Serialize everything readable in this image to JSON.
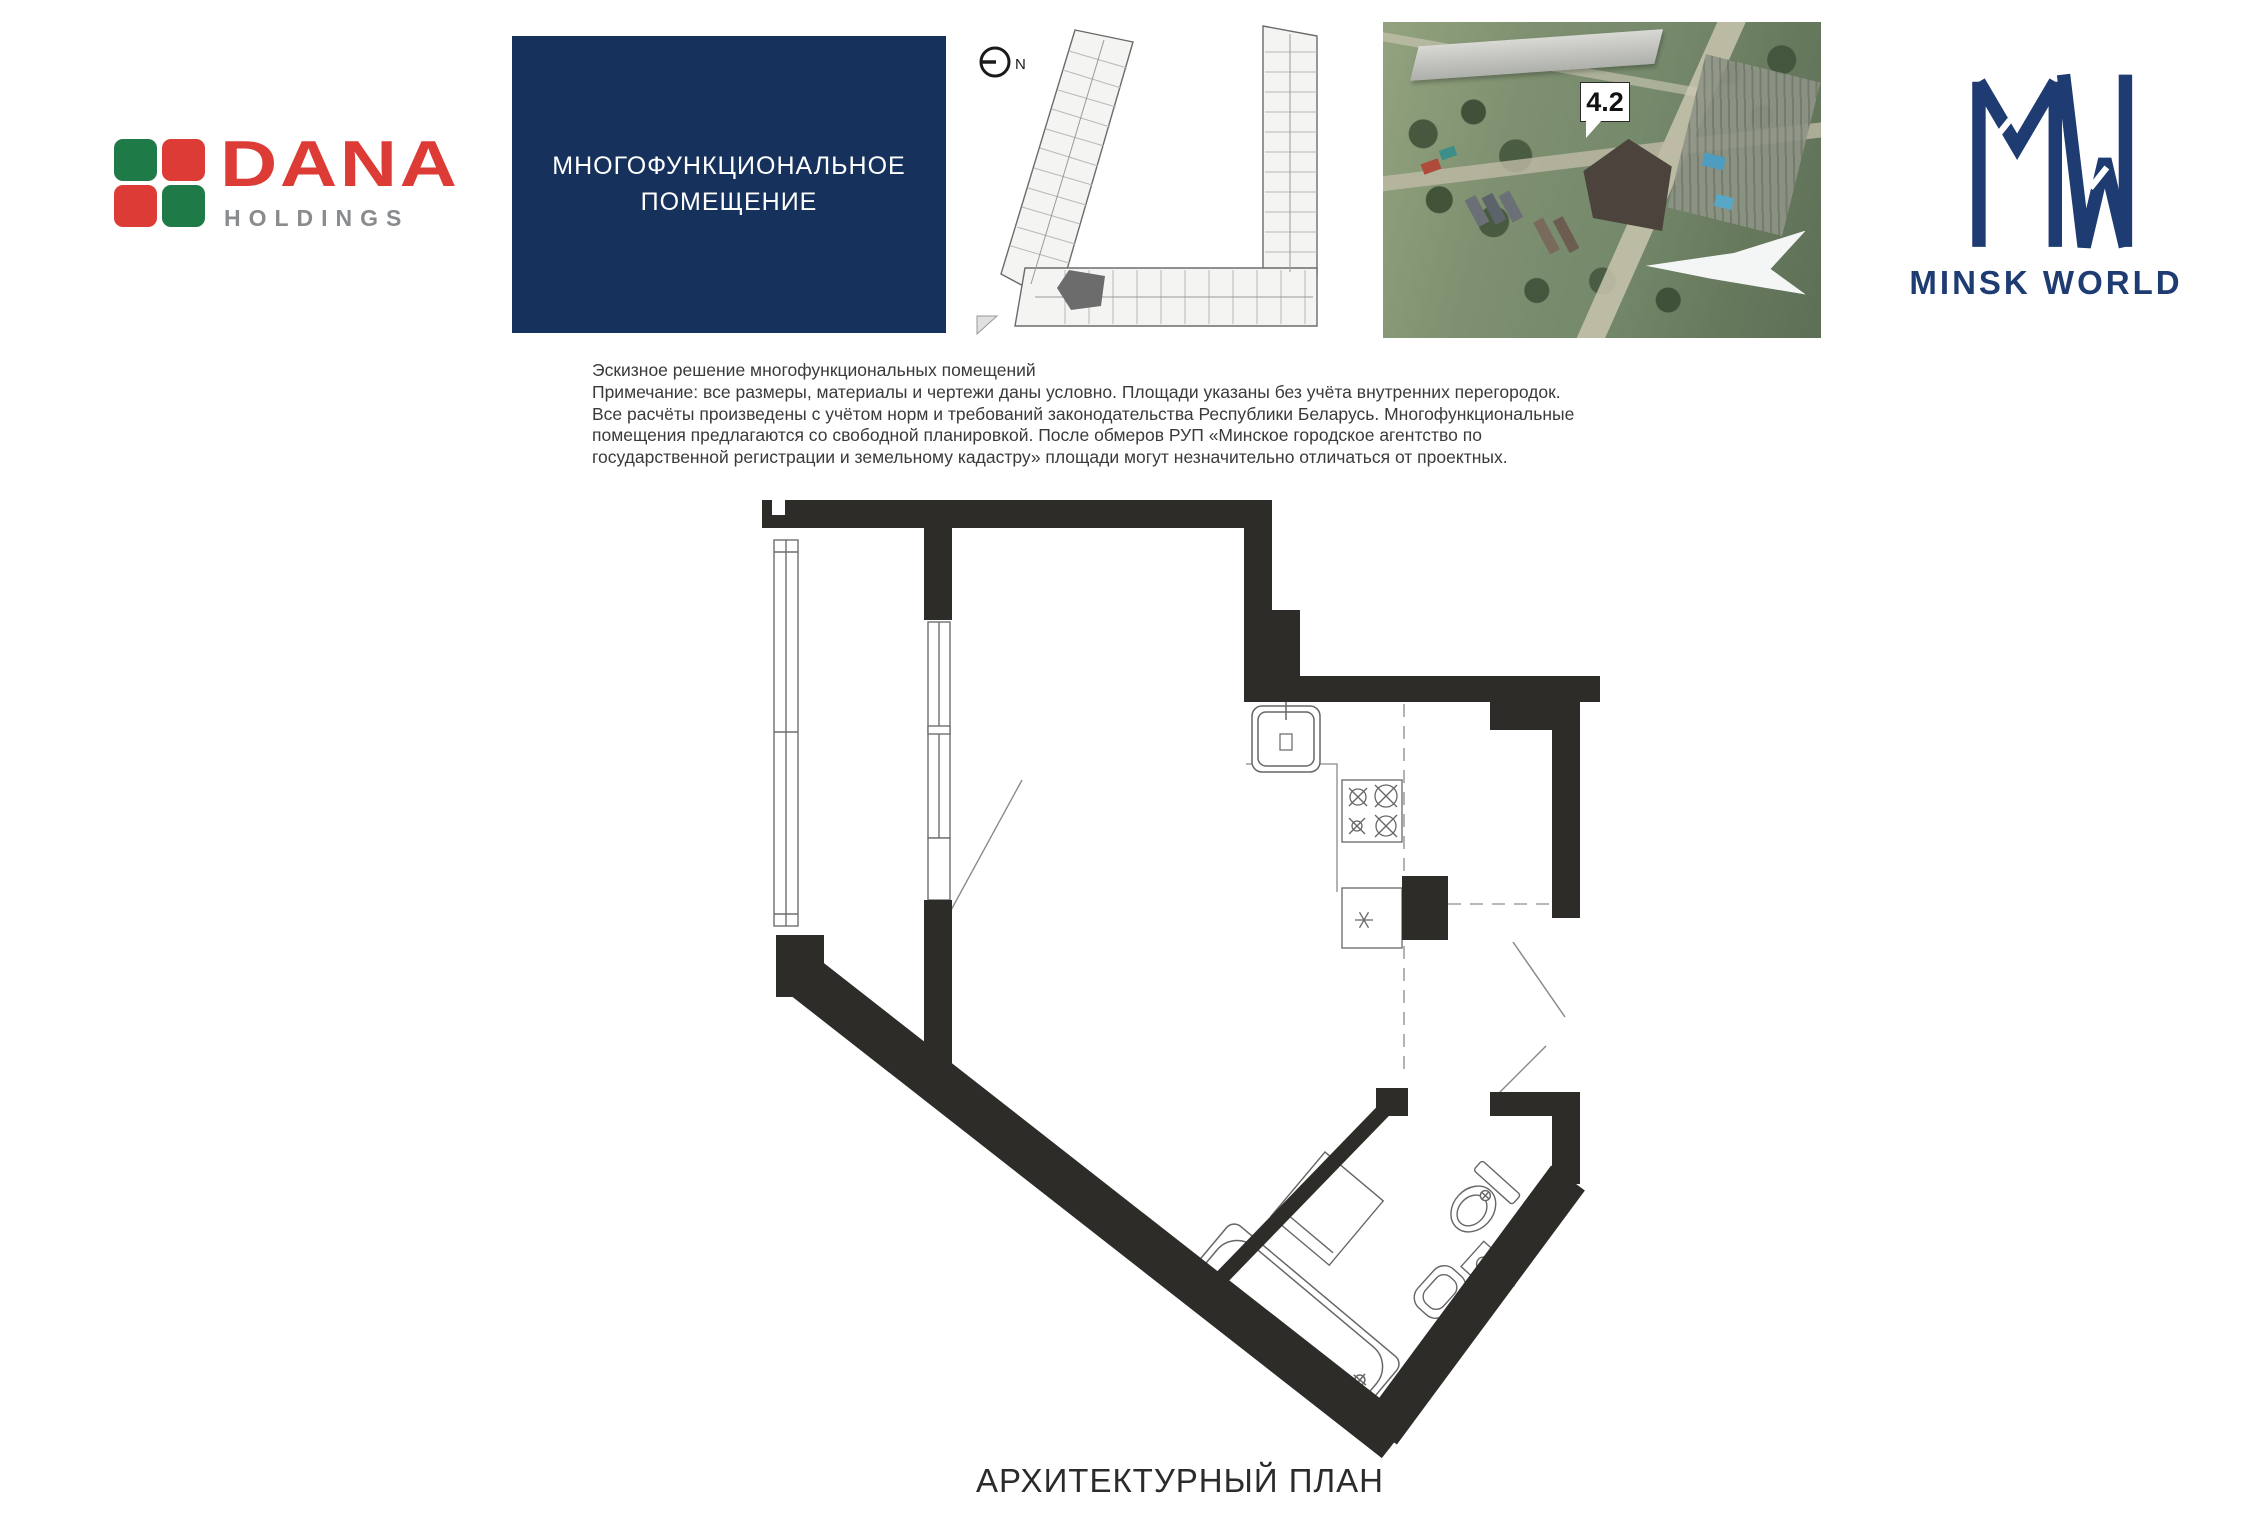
{
  "header": {
    "dana": {
      "title": "DANA",
      "subtitle": "HOLDINGS"
    },
    "title_box": {
      "line1": "МНОГОФУНКЦИОНАЛЬНОЕ",
      "line2": "ПОМЕЩЕНИЕ"
    },
    "key_plan": {
      "north_label": "N"
    },
    "aerial": {
      "badge": "4.2"
    },
    "minsk_world": {
      "brand": "MINSK WORLD"
    }
  },
  "note": {
    "line1": "Эскизное решение многофункциональных помещений",
    "line2": "Примечание: все размеры, материалы и чертежи даны условно. Площади указаны без учёта внутренних перегородок.",
    "line3": "Все расчёты произведены с учётом норм и требований законодательства Республики Беларусь. Многофункциональные",
    "line4": "помещения предлагаются со свободной планировкой. После обмеров РУП «Минское городское агентство по",
    "line5": "государственной регистрации и земельному кадастру» площади могут незначительно отличаться от проектных."
  },
  "plan": {
    "caption": "АРХИТЕКТУРНЫЙ ПЛАН"
  },
  "icons": {
    "compass": "compass-north-icon",
    "badge_pointer": "callout-pointer-icon",
    "monogram": "minsk-world-mw-monogram"
  },
  "colors": {
    "dana_red": "#dd3b35",
    "dana_green": "#1e7a47",
    "dana_gray": "#898c8f",
    "title_box_navy": "#16325c",
    "minsk_world_navy": "#1e3b72",
    "wall_black": "#2e2c29",
    "aerial_green": "#7e9070"
  }
}
